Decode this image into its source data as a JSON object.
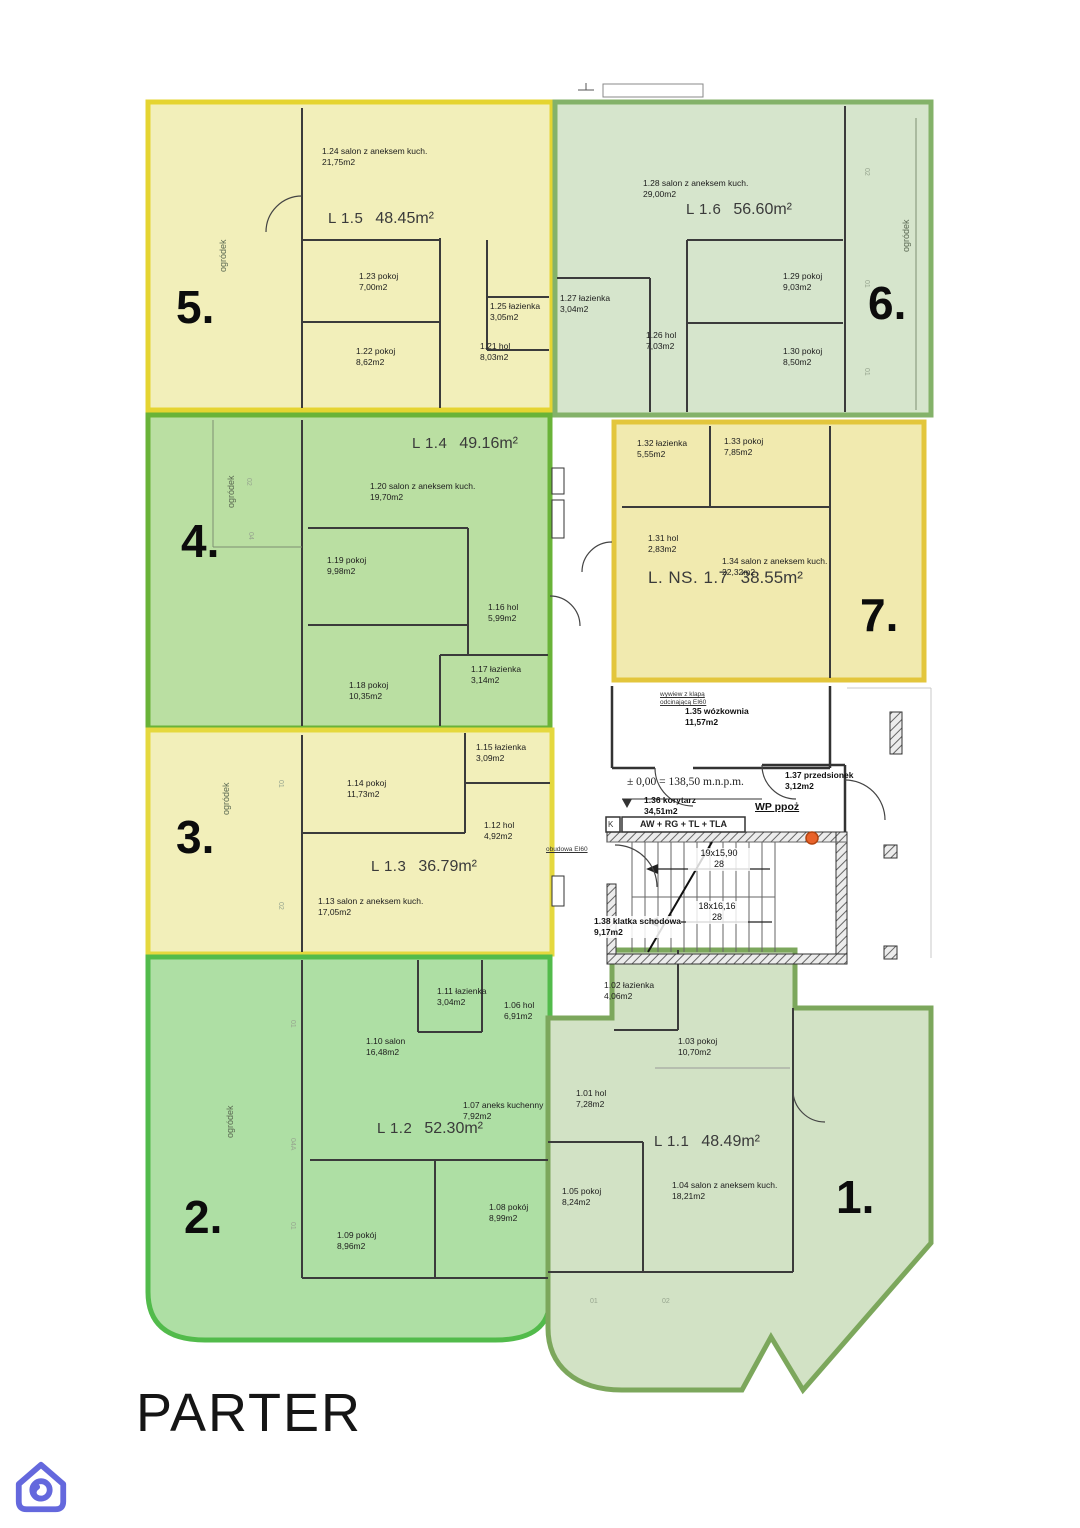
{
  "page": {
    "floor_title": "PARTER"
  },
  "tags": {
    "t01": "01",
    "t02": "02",
    "t04": "04",
    "t04a": "04A"
  },
  "apartments": [
    {
      "num": "1.",
      "unit": "L 1.1",
      "area": "48.49m²",
      "rooms": [
        {
          "n": "1.02 łazienka",
          "a": "4,06m2"
        },
        {
          "n": "1.03 pokoj",
          "a": "10,70m2"
        },
        {
          "n": "1.01 hol",
          "a": "7,28m2"
        },
        {
          "n": "1.05 pokoj",
          "a": "8,24m2"
        },
        {
          "n": "1.04 salon z aneksem kuch.",
          "a": "18,21m2"
        }
      ]
    },
    {
      "num": "2.",
      "unit": "L 1.2",
      "area": "52.30m²",
      "garden": "ogródek",
      "rooms": [
        {
          "n": "1.11 łazienka",
          "a": "3,04m2"
        },
        {
          "n": "1.06 hol",
          "a": "6,91m2"
        },
        {
          "n": "1.10 salon",
          "a": "16,48m2"
        },
        {
          "n": "1.07 aneks kuchenny",
          "a": "7,92m2"
        },
        {
          "n": "1.09 pokój",
          "a": "8,96m2"
        },
        {
          "n": "1.08 pokój",
          "a": "8,99m2"
        }
      ]
    },
    {
      "num": "3.",
      "unit": "L 1.3",
      "area": "36.79m²",
      "garden": "ogródek",
      "rooms": [
        {
          "n": "1.14 pokoj",
          "a": "11,73m2"
        },
        {
          "n": "1.15 łazienka",
          "a": "3,09m2"
        },
        {
          "n": "1.12 hol",
          "a": "4,92m2"
        },
        {
          "n": "1.13 salon z aneksem kuch.",
          "a": "17,05m2"
        }
      ]
    },
    {
      "num": "4.",
      "unit": "L 1.4",
      "area": "49.16m²",
      "garden": "ogródek",
      "rooms": [
        {
          "n": "1.20 salon z aneksem kuch.",
          "a": "19,70m2"
        },
        {
          "n": "1.19 pokoj",
          "a": "9,98m2"
        },
        {
          "n": "1.16 hol",
          "a": "5,99m2"
        },
        {
          "n": "1.18 pokoj",
          "a": "10,35m2"
        },
        {
          "n": "1.17 łazienka",
          "a": "3,14m2"
        }
      ]
    },
    {
      "num": "5.",
      "unit": "L 1.5",
      "area": "48.45m²",
      "garden": "ogródek",
      "rooms": [
        {
          "n": "1.24 salon z aneksem kuch.",
          "a": "21,75m2"
        },
        {
          "n": "1.23 pokoj",
          "a": "7,00m2"
        },
        {
          "n": "1.25 łazienka",
          "a": "3,05m2"
        },
        {
          "n": "1.22 pokoj",
          "a": "8,62m2"
        },
        {
          "n": "1.21 hol",
          "a": "8,03m2"
        }
      ]
    },
    {
      "num": "6.",
      "unit": "L 1.6",
      "area": "56.60m²",
      "garden": "ogródek",
      "rooms": [
        {
          "n": "1.28 salon z aneksem kuch.",
          "a": "29,00m2"
        },
        {
          "n": "1.27 łazienka",
          "a": "3,04m2"
        },
        {
          "n": "1.26 hol",
          "a": "7,03m2"
        },
        {
          "n": "1.29 pokoj",
          "a": "9,03m2"
        },
        {
          "n": "1.30 pokoj",
          "a": "8,50m2"
        }
      ]
    },
    {
      "num": "7.",
      "unit": "L. NS. 1.7",
      "area": "38.55m²",
      "rooms": [
        {
          "n": "1.32 łazienka",
          "a": "5,55m2"
        },
        {
          "n": "1.33 pokoj",
          "a": "7,85m2"
        },
        {
          "n": "1.31 hol",
          "a": "2,83m2"
        },
        {
          "n": "1.34 salon z aneksem kuch.",
          "a": "22,32m2"
        }
      ]
    }
  ],
  "common": {
    "wozkownia_n": "1.35 wózkownia",
    "wozkownia_a": "11,57m2",
    "korytarz_n": "1.36 korytarz",
    "korytarz_a": "34,51m2",
    "przedsionek_n": "1.37 przedsionek",
    "przedsionek_a": "3,12m2",
    "klatka_n": "1.38 klatka schodowa",
    "klatka_a": "9,17m2",
    "level_mark": "± 0,00 = 138,50 m.n.p.m.",
    "panel": "AW + RG + TL + TLA",
    "panel_k": "K",
    "wp": "WP ppoż",
    "stairs_up_n": "19x15,90",
    "stairs_up_c": "28",
    "stairs_down_n": "18x16,16",
    "stairs_down_c": "28",
    "vent_note_1": "wywiew z klapą",
    "vent_note_2": "odcinającą EI60",
    "enclosure_note": "obudowa EI60"
  },
  "colors": {
    "apt_yellow_fill": "#f2efba",
    "apt_yellow_border": "#e5d431",
    "apt_green_fill": "#aedfa4",
    "apt_green_border": "#52bb4b",
    "apt_midgreen_fill": "#badfa2",
    "apt_midgreen_border": "#69b338",
    "apt_palegreen_fill": "#d6e5cc",
    "apt_palegreen_border": "#84b269",
    "apt_sage_fill": "#d2e2c5",
    "apt_sage_border": "#7ca75c",
    "hydrant": "#e8622a",
    "logo": "#6468dd"
  }
}
